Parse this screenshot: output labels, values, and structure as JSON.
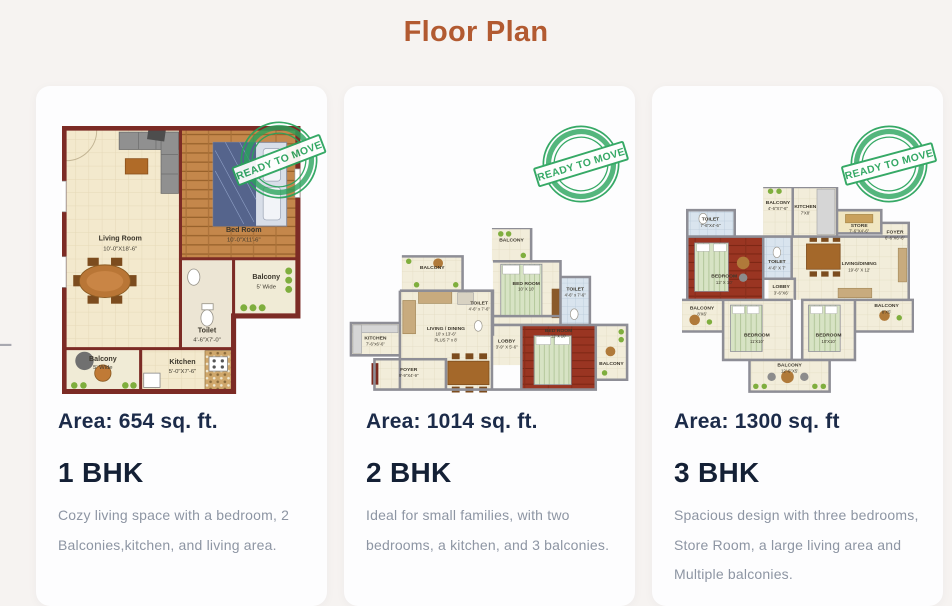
{
  "page": {
    "title": "Floor Plan"
  },
  "carousel": {
    "prev_label": "←"
  },
  "stamp": {
    "text": "READY TO MOVE",
    "color": "#28a35b"
  },
  "colors": {
    "accent": "#b25a31",
    "heading_dark": "#1c2b49",
    "muted_text": "#8d95a3",
    "page_bg": "#f6f3f1",
    "card_bg": "#fdfdfe",
    "plan1_wall": "#7c2b25",
    "plan_wall_gray": "#8e8e96"
  },
  "cards": [
    {
      "area_label": "Area: 654 sq. ft.",
      "bhk_label": "1 BHK",
      "description": "Cozy living space with a bedroom, 2 Balconies,kitchen, and living area.",
      "plan": {
        "living_name": "Living Room",
        "living_dims": "10'-0\"X18'-6\"",
        "bed_name": "Bed Room",
        "bed_dims": "10'-0\"X11'-6\"",
        "balcony_r_name": "Balcony",
        "balcony_r_dims": "5' Wide",
        "toilet_name": "Toilet",
        "toilet_dims": "4'-6\"X7'-0\"",
        "kitchen_name": "Kitchen",
        "kitchen_dims": "5'-0\"X7'-6\"",
        "balcony_b_name": "Balcony",
        "balcony_b_dims": "5' Wide"
      }
    },
    {
      "area_label": "Area: 1014 sq. ft.",
      "bhk_label": "2 BHK",
      "description": "Ideal for small families, with two bedrooms, a kitchen, and 3 balconies.",
      "plan": {
        "balcony_top": "BALCONY",
        "balcony_ul": "BALCONY",
        "bed1_name": "BED ROOM",
        "bed1_dims": "10' X 10'",
        "toilet1_name": "TOILET",
        "toilet1_dims": "4'-6\" x 7'-6\"",
        "toilet2_name": "TOILET",
        "toilet2_dims": "4'-6\" x 7'-6\"",
        "kitchen_name": "KITCHEN",
        "kitchen_dims": "7'-6\"x6'-6\"",
        "living_name": "LIVING / DINING",
        "living_dims": "10' x 13'-6\"",
        "living_dims2": "PLUS 7' x 8'",
        "lobby_name": "LOBBY",
        "lobby_dims": "3'-9\" X 5'-6\"",
        "bed2_name": "BED ROOM",
        "bed2_dims": "12' x 10'",
        "balcony_r": "BALCONY",
        "foyer_name": "FOYER",
        "foyer_dims": "9'-9\"X4'-9\""
      }
    },
    {
      "area_label": "Area: 1300 sq. ft",
      "bhk_label": "3 BHK",
      "description": "Spacious design with three bedrooms, Store Room, a large living area and Multiple balconies.",
      "plan": {
        "toilet1_name": "TOILET",
        "toilet1_dims": "7'-6\"X4'-6\"",
        "bed1_name": "BEDROOM",
        "bed1_dims": "12' X 10'",
        "balcony_top_name": "BALCONY",
        "balcony_top_dims": "4'-6\"X7'-6\"",
        "toilet2_name": "TOILET",
        "toilet2_dims": "4'-6\" X 7'",
        "kitchen_name": "KITCHEN",
        "kitchen_dims": "7'X8'",
        "store_name": "STORE",
        "store_dims": "7'-6\"X4'-6\"",
        "foyer_name": "FOYER",
        "foyer_dims": "6'-6\"X6'-6\"",
        "living_name": "LIVING/DINING",
        "living_dims": "19'-6\" X 12'",
        "lobby_name": "LOBBY",
        "lobby_dims": "3'-6\"X6'",
        "balcony_l_name": "BALCONY",
        "balcony_l_dims": "8'X6'",
        "bed2_name": "BEDROOM",
        "bed2_dims": "11'X10'",
        "bed3_name": "BEDROOM",
        "bed3_dims": "10'X10'",
        "balcony_r_name": "BALCONY",
        "balcony_r_dims": "8'X5'",
        "balcony_b_name": "BALCONY",
        "balcony_b_dims": "12'-6\"X5'"
      }
    }
  ]
}
